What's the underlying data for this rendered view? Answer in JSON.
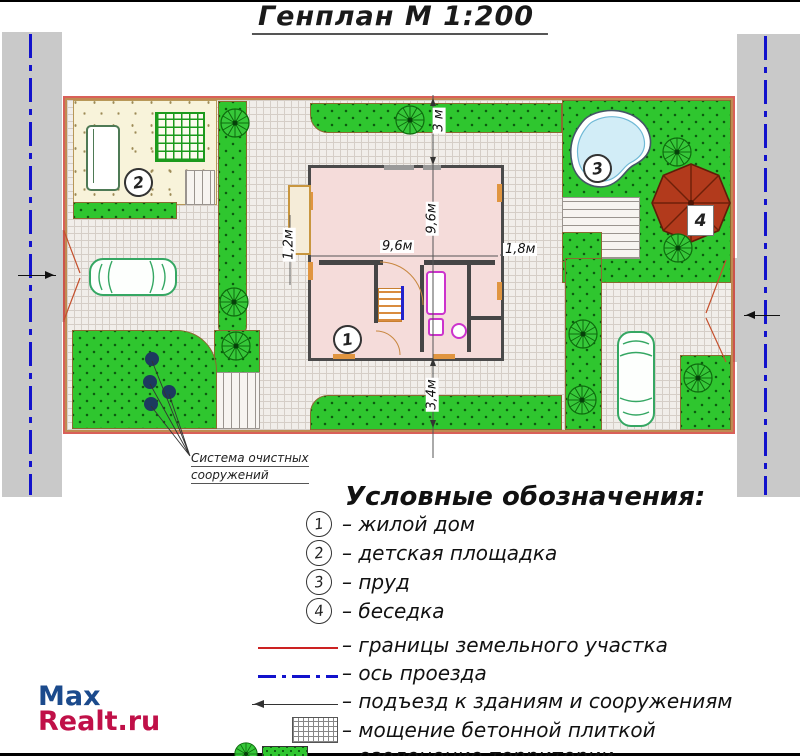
{
  "title": "Генплан М 1:200",
  "plan": {
    "markers": {
      "house": "1",
      "playground": "2",
      "pond": "3",
      "gazebo": "4"
    },
    "dimensions": {
      "top": "3 м",
      "vertical": "9,6м",
      "horizontal": "9,6м",
      "left": "1,2м",
      "right": "1,8м",
      "bottom": "3,4м"
    },
    "note_line1": "Система очистных",
    "note_line2": "сооружений"
  },
  "legend": {
    "header": "Условные обозначения:",
    "numbered": [
      {
        "num": "1",
        "label": "– жилой дом"
      },
      {
        "num": "2",
        "label": "– детская площадка"
      },
      {
        "num": "3",
        "label": "– пруд"
      },
      {
        "num": "4",
        "label": "– беседка"
      }
    ],
    "symbols": [
      {
        "icon": "red-line",
        "label": "– границы земельного участка"
      },
      {
        "icon": "blue-dash-dot-line",
        "label": "– ось проезда"
      },
      {
        "icon": "access-arrow",
        "label": "– подъезд к зданиям и сооружениям"
      },
      {
        "icon": "paving-grid-swatch",
        "label": "– мощение бетонной плиткой"
      },
      {
        "icon": "greenery-swatch",
        "label": "– озеленение территории"
      }
    ]
  },
  "logo": {
    "part1": "Max",
    "part2": "Realt.ru"
  },
  "colors": {
    "lawn_green": "#2fc62f",
    "road_gray": "#c9c9c9",
    "axis_blue": "#1212cc",
    "boundary_red": "#cc2b22",
    "boundary_tan": "#c08a52",
    "house_fill": "#f5dcda",
    "pond_fill": "#d2edf7",
    "gazebo_red": "#b23a1c",
    "playground_fill": "#f8f3da",
    "logo_blue": "#1b4a8c",
    "logo_red": "#c01048"
  }
}
